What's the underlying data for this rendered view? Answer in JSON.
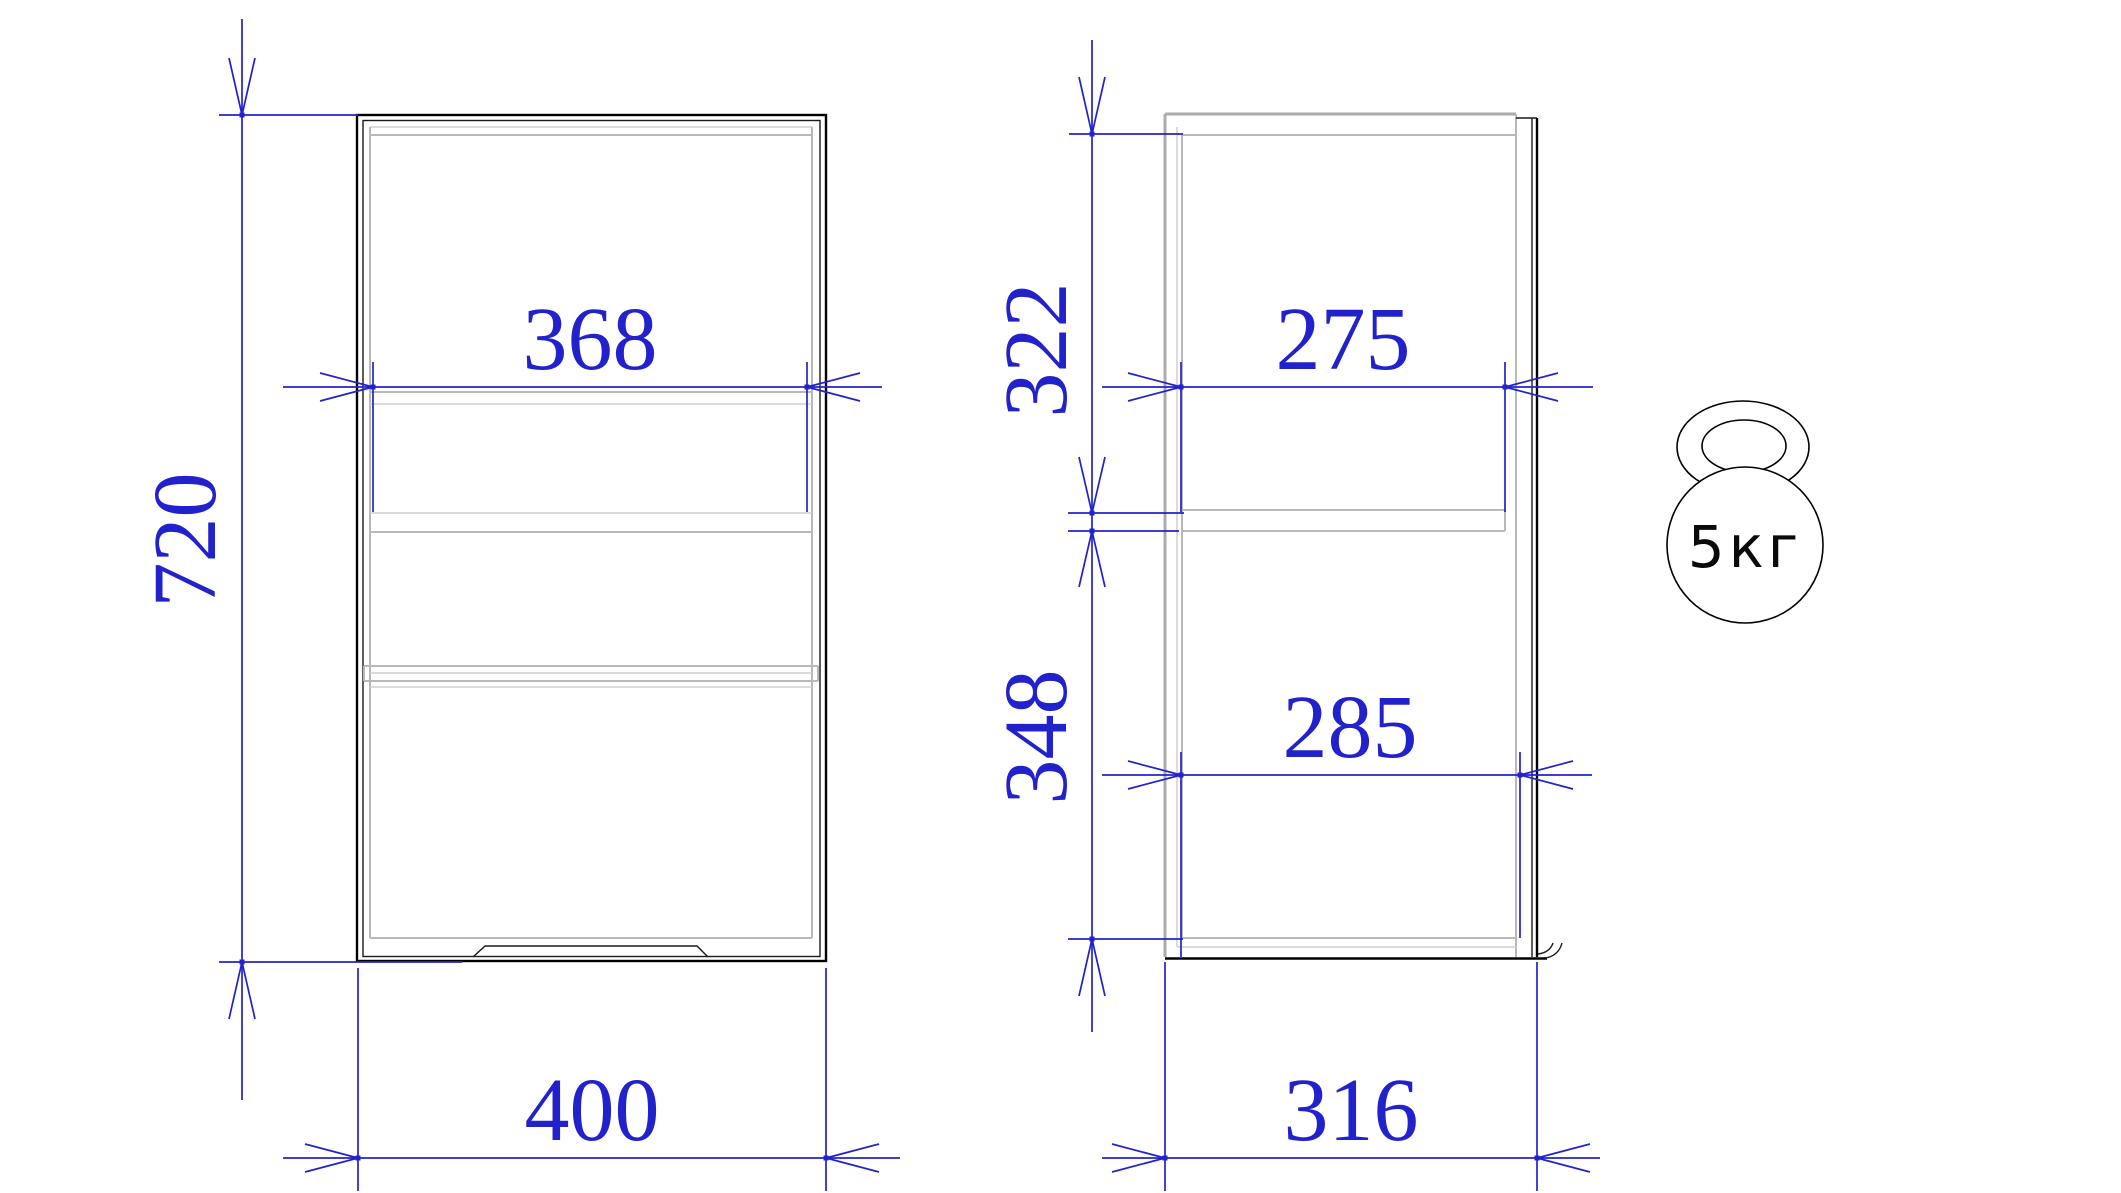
{
  "colors": {
    "dimension_blue": "#2222cc",
    "outline_black": "#000000",
    "secondary_gray": "#b9b9b9"
  },
  "front_view": {
    "dims": {
      "interior_width": "368",
      "overall_height": "720",
      "overall_width": "400"
    }
  },
  "side_view": {
    "dims": {
      "upper_section_height": "322",
      "upper_interior_depth": "275",
      "lower_section_height": "348",
      "lower_interior_depth": "285",
      "overall_depth": "316"
    }
  },
  "weight_capacity": {
    "label": "5кг"
  }
}
